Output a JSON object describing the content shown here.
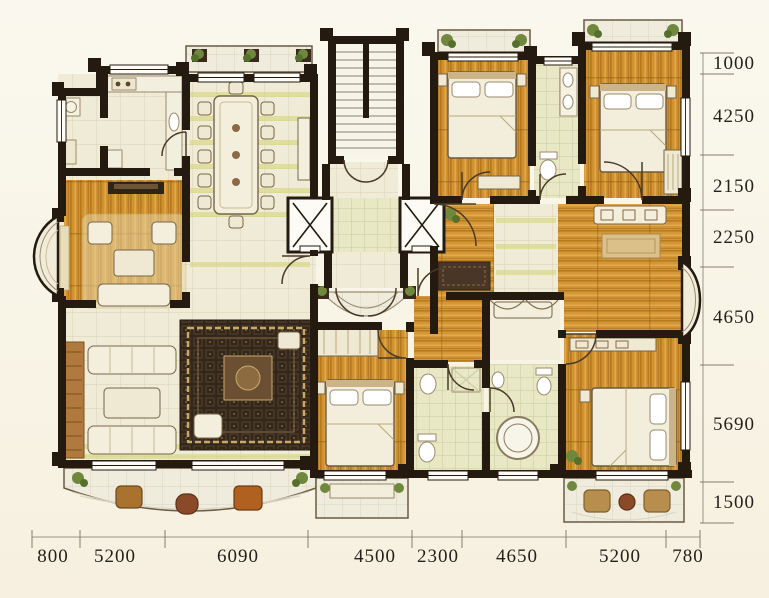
{
  "dimensions": {
    "right": [
      "1000",
      "4250",
      "2150",
      "2250",
      "4650",
      "5690",
      "1500"
    ],
    "bottom": [
      "800",
      "5200",
      "6090",
      "4500",
      "2300",
      "4650",
      "5200",
      "780"
    ]
  },
  "palette": {
    "background": "#f8f4e6",
    "wall": "#241a10",
    "wood_floor": "#d09130",
    "tile_floor": "#f0ebd6",
    "bath_tile": "#e8e8c4",
    "accent_band": "#d6d77a",
    "carpet": "#33271b",
    "balcony_tile": "#efecdd",
    "dimension_text": "#24211c"
  }
}
